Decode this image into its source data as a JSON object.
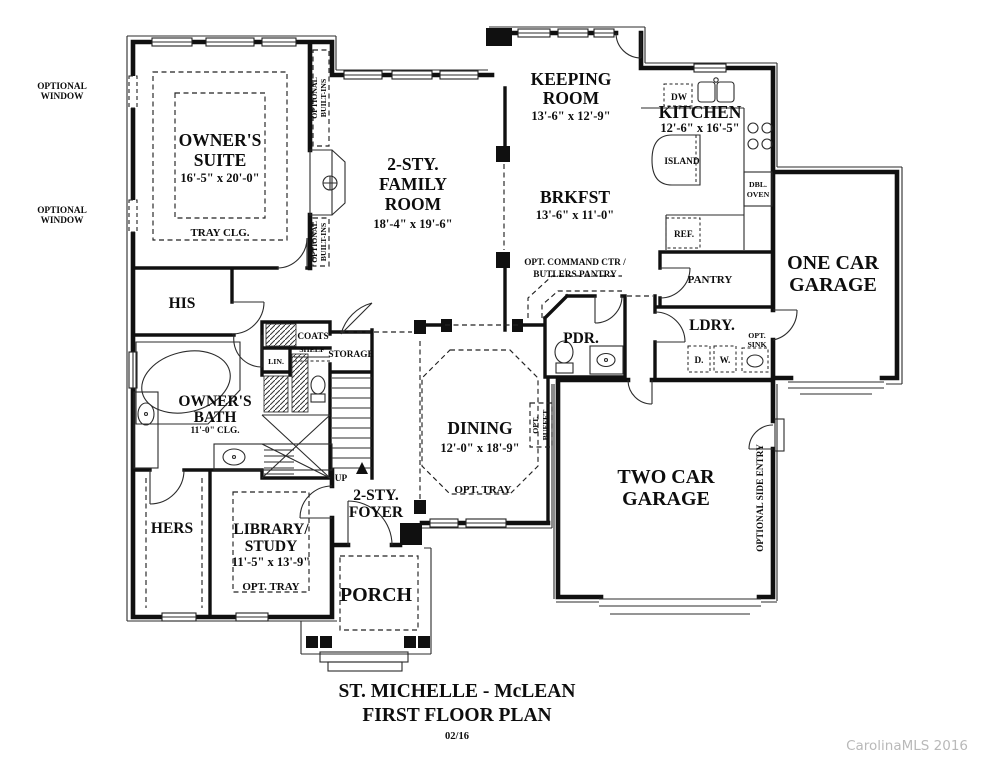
{
  "plan": {
    "title1": "ST. MICHELLE - McLEAN",
    "title2": "FIRST FLOOR PLAN",
    "title3": "02/16",
    "watermark": "CarolinaMLS 2016"
  },
  "rooms": {
    "owners_suite": {
      "n1": "OWNER'S",
      "n2": "SUITE",
      "dims": "16'-5\" x 20'-0\"",
      "note": "TRAY CLG."
    },
    "family_room": {
      "n1": "2-STY.",
      "n2": "FAMILY",
      "n3": "ROOM",
      "dims": "18'-4\" x 19'-6\""
    },
    "keeping_room": {
      "n1": "KEEPING",
      "n2": "ROOM",
      "dims": "13'-6\" x 12'-9\""
    },
    "kitchen": {
      "n1": "KITCHEN",
      "dims": "12'-6\" x 16'-5\""
    },
    "brkfst": {
      "n1": "BRKFST",
      "dims": "13'-6\" x 11'-0\""
    },
    "dining": {
      "n1": "DINING",
      "dims": "12'-0\" x 18'-9\"",
      "note": "OPT. TRAY"
    },
    "foyer": {
      "n1": "2-STY.",
      "n2": "FOYER"
    },
    "library": {
      "n1": "LIBRARY/",
      "n2": "STUDY",
      "dims": "11'-5\" x 13'-9\"",
      "note": "OPT. TRAY"
    },
    "owners_bath": {
      "n1": "OWNER'S",
      "n2": "BATH",
      "note": "11'-0\" CLG."
    },
    "his": "HIS",
    "hers": "HERS",
    "pdr": "PDR.",
    "ldry": "LDRY.",
    "pantry": "PANTRY",
    "one_car_garage": {
      "n1": "ONE CAR",
      "n2": "GARAGE"
    },
    "two_car_garage": {
      "n1": "TWO CAR",
      "n2": "GARAGE"
    },
    "porch": "PORCH",
    "storage": "STORAGE",
    "coats": "COATS",
    "lin": "LIN.",
    "shelf": "SHELF"
  },
  "labels": {
    "optional_window": {
      "l1": "OPTIONAL",
      "l2": "WINDOW"
    },
    "optional_builtins": {
      "l1": "OPTIONAL",
      "l2": "BUILT-INS"
    },
    "command_ctr": {
      "l1": "OPT. COMMAND CTR /",
      "l2": "BUTLERS PANTRY"
    },
    "dw": "DW",
    "island": "ISLAND",
    "dbl_oven": {
      "l1": "DBL.",
      "l2": "OVEN"
    },
    "ref": "REF.",
    "opt_sink": {
      "l1": "OPT.",
      "l2": "SINK"
    },
    "dryer": "D.",
    "washer": "W.",
    "up": "UP",
    "opt_buffet": {
      "l1": "OPT.",
      "l2": "BUFFET"
    },
    "side_entry": "OPTIONAL SIDE ENTRY"
  }
}
